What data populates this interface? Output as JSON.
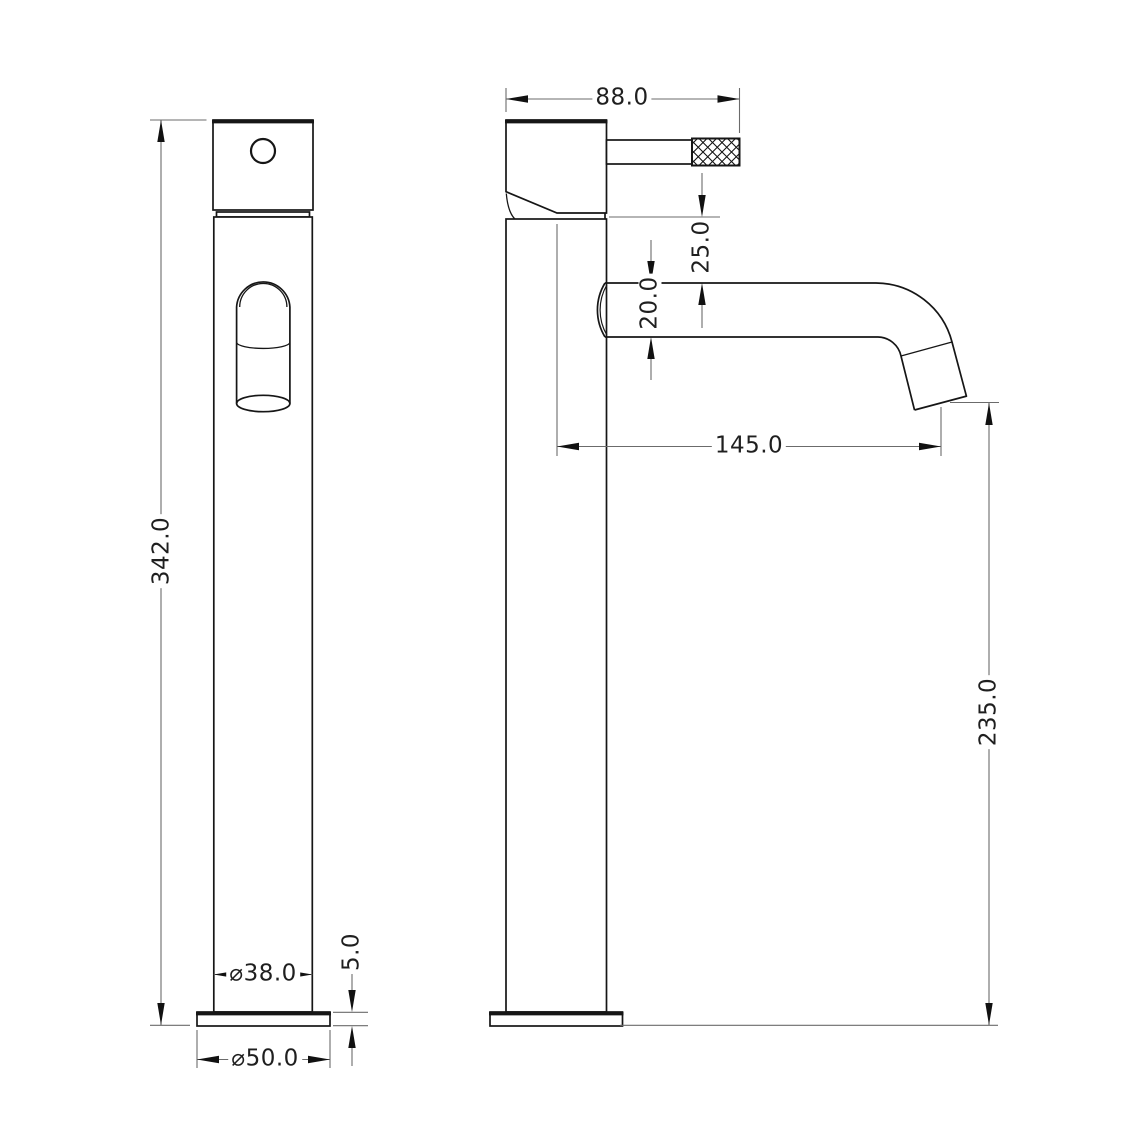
{
  "drawing": {
    "type": "technical-dimension-drawing",
    "subject": "tall single-lever basin mixer tap, front and side views",
    "colors": {
      "background": "#ffffff",
      "outline": "#161616",
      "dimension_lines": "#6b6b6b",
      "arrowheads": "#111111",
      "text": "#1f1f1f"
    },
    "front_view": {
      "dimensions": {
        "overall_height": "342.0",
        "body_diameter": "⌀38.0",
        "base_height": "5.0",
        "base_diameter": "⌀50.0"
      }
    },
    "side_view": {
      "dimensions": {
        "head_width": "88.0",
        "head_to_spout": "25.0",
        "spout_diameter": "20.0",
        "spout_reach": "145.0",
        "outlet_to_base": "235.0"
      }
    }
  }
}
